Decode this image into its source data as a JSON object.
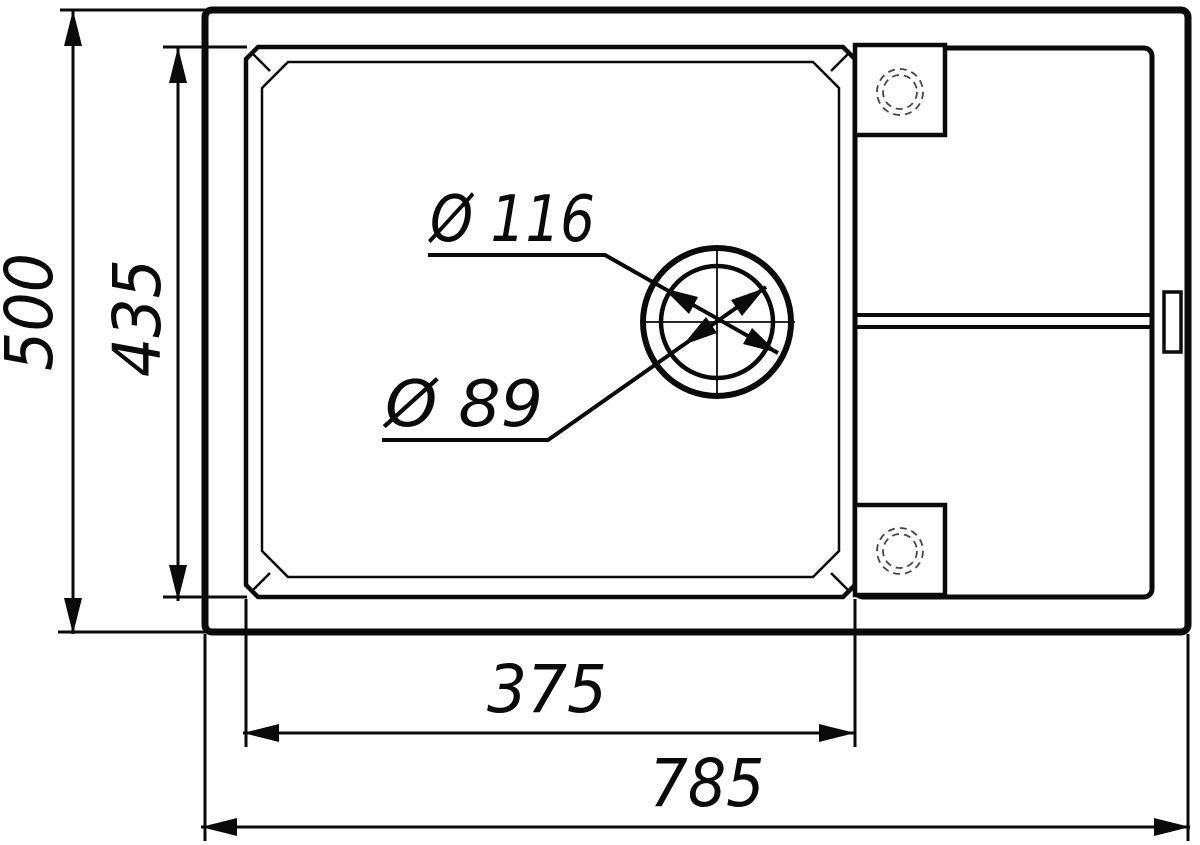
{
  "drawing": {
    "kind": "technical-dimension-drawing",
    "subject": "kitchen sink with drainboard, top view",
    "colors": {
      "line": "#0a0a0a",
      "background": "#ffffff",
      "knockout_dashed": "#444444"
    },
    "dimension_labels": {
      "overall_width": "785",
      "overall_depth": "500",
      "bowl_width": "375",
      "bowl_depth": "435",
      "drain_outer_diameter": "Ø 116",
      "drain_inner_diameter": "Ø 89"
    },
    "dimension_values": {
      "overall_width": 785,
      "overall_depth": 500,
      "bowl_width": 375,
      "bowl_depth": 435,
      "drain_outer_diameter": 116,
      "drain_inner_diameter": 89
    }
  }
}
